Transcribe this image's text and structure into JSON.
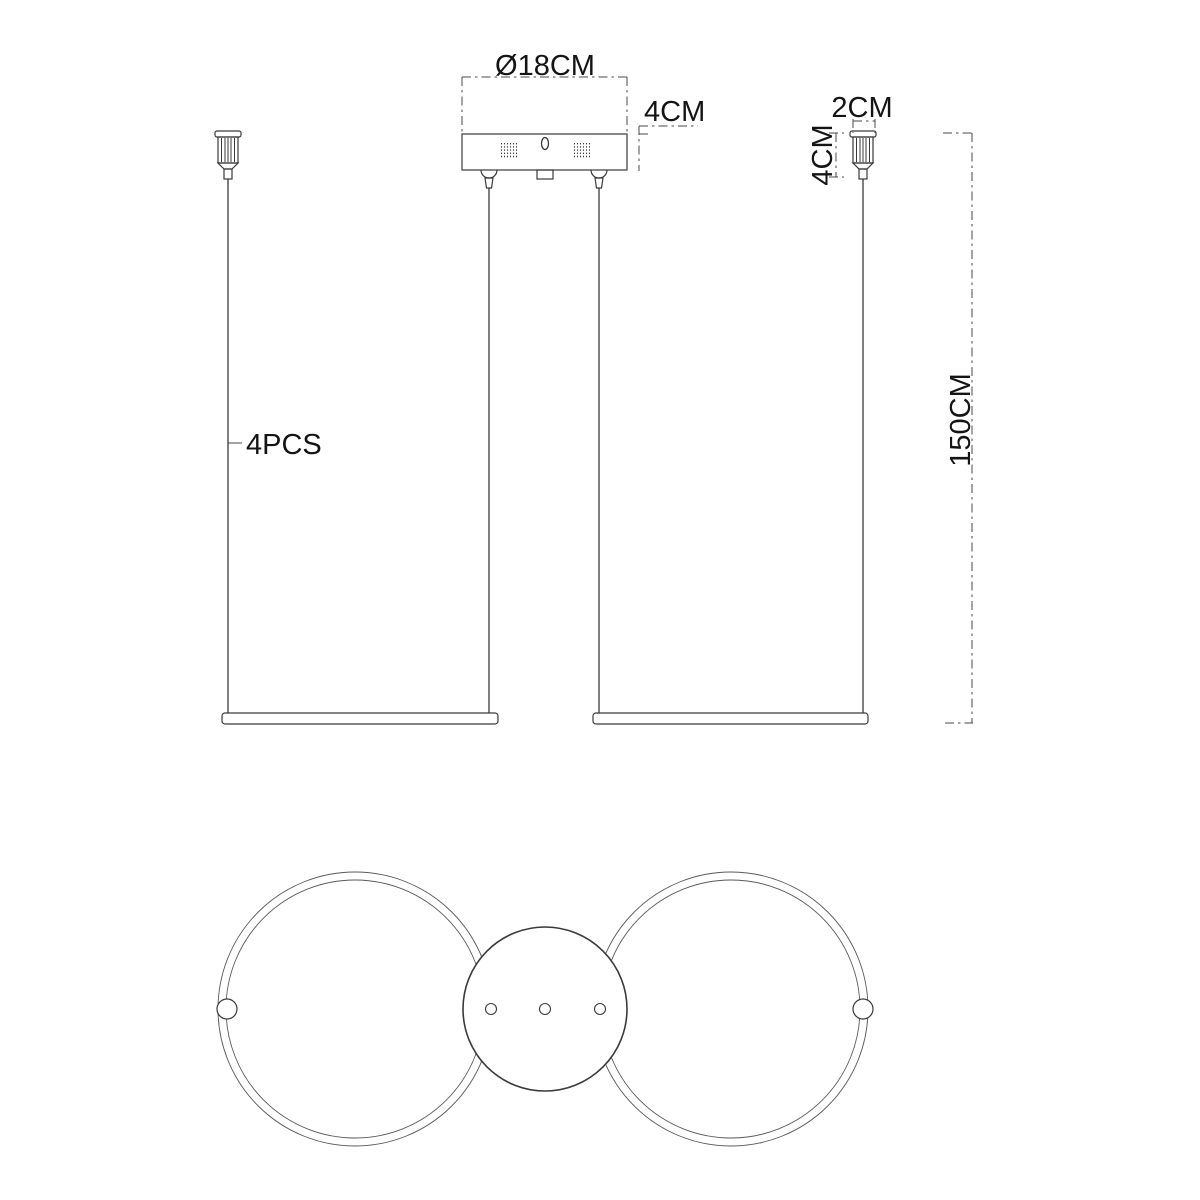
{
  "colors": {
    "line": "#3a3a3a",
    "ring": "#5a5a5a",
    "dim": "#4a4a4a",
    "text": "#141414",
    "background": "#ffffff"
  },
  "labels": {
    "canopy_diameter": "Ø18CM",
    "canopy_height": "4CM",
    "hanger_width": "2CM",
    "hanger_height": "4CM",
    "drop_length": "150CM",
    "cable_count": "4PCS"
  }
}
